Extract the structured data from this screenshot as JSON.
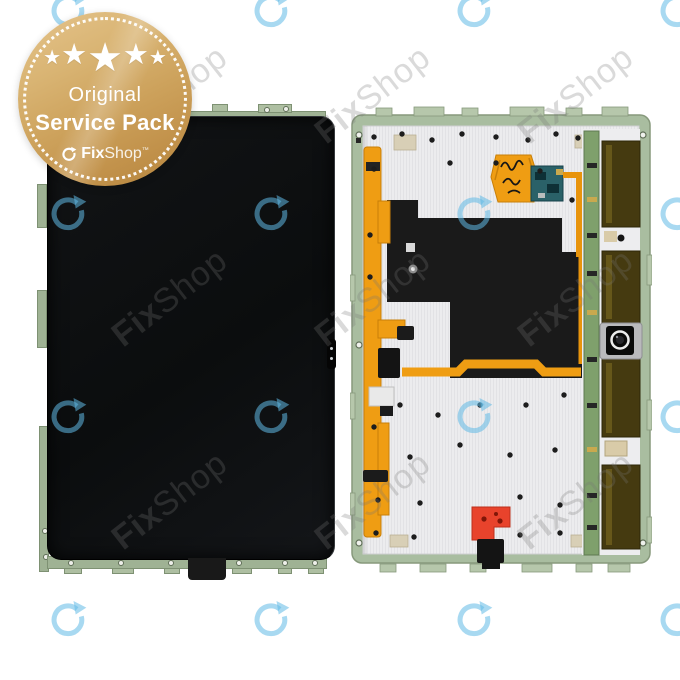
{
  "page": {
    "background": "#ffffff"
  },
  "badge": {
    "stars": 5,
    "line1": "Original",
    "line2": "Service Pack",
    "brand": {
      "bold": "Fix",
      "light": "Shop",
      "tm": "™"
    },
    "colors": {
      "gold_light": "#e5c48c",
      "gold_dark": "#b4843d",
      "text": "#ffffff"
    }
  },
  "watermark": {
    "text": "FixShop",
    "brand_bold": "Fix",
    "brand_light": "Shop",
    "arrow_color": "rgba(96,186,230,0.55)",
    "text_color": "rgba(118,118,118,0.27)"
  },
  "product_photo": {
    "subject": "tablet display assembly front and back",
    "colors": {
      "frame_green": "#a9bda0",
      "backplate_white": "#ececee",
      "screen_black": "#0e1012",
      "graphite_sheet": "#1a1a1a",
      "flex_orange": "#ef9d13",
      "pcb_teal": "#2a6168",
      "pcb_strip_green": "#7fa06c",
      "driver_flex_olive": "#453a10",
      "connector_red": "#e8432c",
      "connector_black": "#141414"
    }
  }
}
